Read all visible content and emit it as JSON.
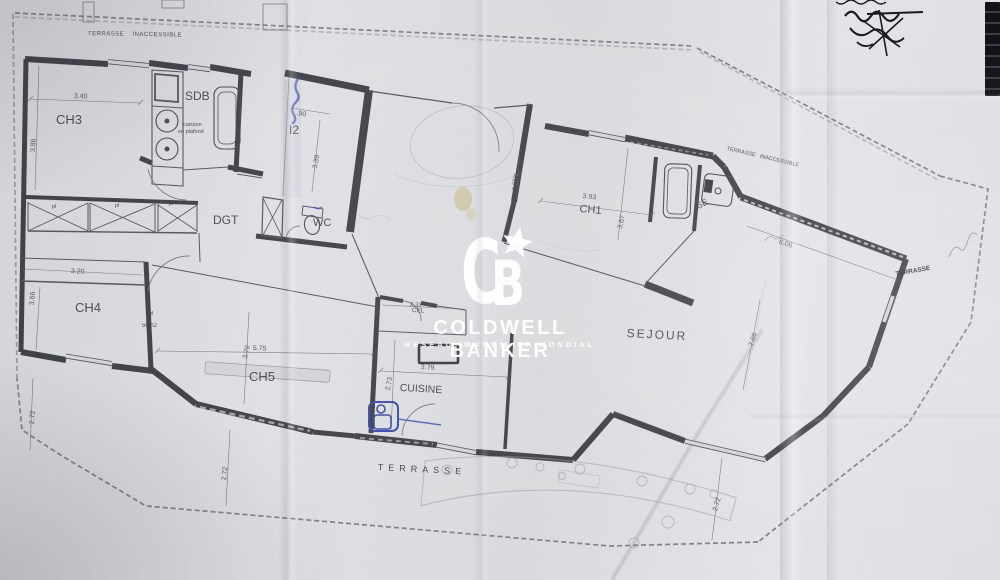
{
  "watermark": {
    "monogram_c": "C",
    "monogram_b": "B",
    "brand": "COLDWELL BANKER",
    "tagline": "RESEAU IMMOBILIER MONDIAL",
    "color": "#ffffff"
  },
  "plan": {
    "rooms": [
      {
        "id": "terrasse-inaccessible-top",
        "text": "TERRASSE  INACCESSIBLE"
      },
      {
        "id": "ch3",
        "text": "CH3"
      },
      {
        "id": "sdb",
        "text": "SDB"
      },
      {
        "id": "caisson-line1",
        "text": "caisson"
      },
      {
        "id": "caisson-line2",
        "text": "en plafond"
      },
      {
        "id": "i2",
        "text": "I2"
      },
      {
        "id": "dgt",
        "text": "DGT"
      },
      {
        "id": "wc",
        "text": "WC"
      },
      {
        "id": "ch1",
        "text": "CH1"
      },
      {
        "id": "se",
        "text": "SE"
      },
      {
        "id": "terrasse-inaccessible-right",
        "text": "TERRASSE  INACCESSIBLE"
      },
      {
        "id": "ch4",
        "text": "CH4"
      },
      {
        "id": "pl-1",
        "text": "pl"
      },
      {
        "id": "pl-2",
        "text": "pl"
      },
      {
        "id": "pl-3",
        "text": "pl"
      },
      {
        "id": "pl-4",
        "text": "pl"
      },
      {
        "id": "pl-area",
        "text": "50m2"
      },
      {
        "id": "ch5",
        "text": "CH5"
      },
      {
        "id": "cel",
        "text": "CEL"
      },
      {
        "id": "cuisine",
        "text": "CUISINE"
      },
      {
        "id": "sejour",
        "text": "SEJOUR"
      },
      {
        "id": "terrasse-right",
        "text": "TERRASSE"
      },
      {
        "id": "terrasse-bottom",
        "text": "TERRASSE"
      }
    ],
    "dimensions": [
      {
        "id": "ch3-width",
        "text": "3.40"
      },
      {
        "id": "ch3-height",
        "text": "3.86"
      },
      {
        "id": "i2-width",
        "text": ".90"
      },
      {
        "id": "i2-height",
        "text": "3.39"
      },
      {
        "id": "hall-width",
        "text": "1.28m"
      },
      {
        "id": "ch1-width",
        "text": "3.93"
      },
      {
        "id": "ch1-height",
        "text": "3.67"
      },
      {
        "id": "sejour-top",
        "text": "6.06"
      },
      {
        "id": "sejour-height",
        "text": "7.06"
      },
      {
        "id": "ch4-width",
        "text": "3.20"
      },
      {
        "id": "ch4-height",
        "text": "3.66"
      },
      {
        "id": "ch5-width",
        "text": "5.75"
      },
      {
        "id": "ch5-height",
        "text": "3.79"
      },
      {
        "id": "cuisine-width",
        "text": "3.79"
      },
      {
        "id": "cuisine-height",
        "text": "2.73"
      },
      {
        "id": "cel-width",
        "text": "2.33"
      },
      {
        "id": "terrace-left",
        "text": "2.72"
      },
      {
        "id": "terrace-mid",
        "text": "2.72"
      },
      {
        "id": "terrace-right",
        "text": "2.72"
      }
    ]
  },
  "colors": {
    "paper": "#dfe0e3",
    "wall_ink": "#35363e",
    "thin_ink": "#55565f",
    "blue_ink": "#3d4da6",
    "stain": "#c4aa5f",
    "watermark": "#ffffff"
  }
}
